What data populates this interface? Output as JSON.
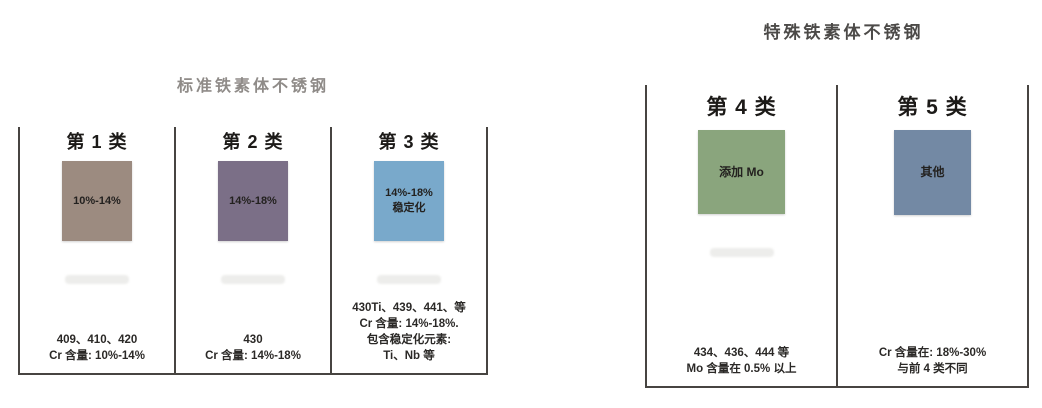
{
  "standard_group": {
    "title": "标准铁素体不锈钢",
    "columns": [
      {
        "header": "第 1 类",
        "box_label": "10%-14%",
        "box_color": "#9c8b80",
        "note": "409、410、420\nCr 含量: 10%-14%"
      },
      {
        "header": "第 2 类",
        "box_label": "14%-18%",
        "box_color": "#7b6f87",
        "note": "430\nCr 含量: 14%-18%"
      },
      {
        "header": "第 3 类",
        "box_label": "14%-18%\n稳定化",
        "box_color": "#79a9cb",
        "note": "430Ti、439、441、等\nCr 含量: 14%-18%.\n包含稳定化元素:\nTi、Nb 等"
      }
    ]
  },
  "special_group": {
    "title": "特殊铁素体不锈钢",
    "columns": [
      {
        "header": "第 4 类",
        "box_label": "添加 Mo",
        "box_color": "#8aa57d",
        "note": "434、436、444 等\nMo 含量在 0.5% 以上"
      },
      {
        "header": "第 5 类",
        "box_label": "其他",
        "box_color": "#7389a4",
        "note": "Cr 含量在: 18%-30%\n与前 4 类不同"
      }
    ]
  },
  "colors": {
    "border": "#474441",
    "title_standard": "#8f8b88",
    "title_special": "#4c4a48"
  }
}
